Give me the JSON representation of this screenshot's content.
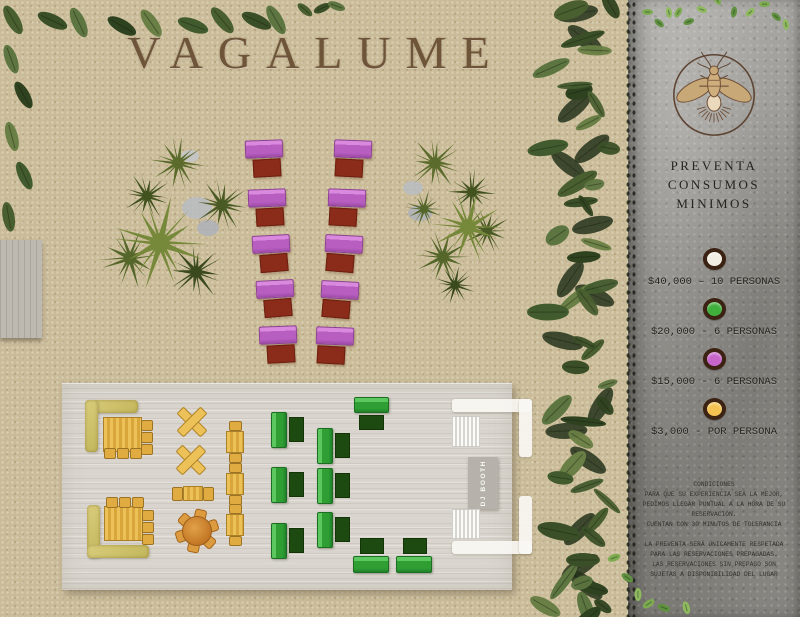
{
  "title": "VAGALUME",
  "sidebar": {
    "heading": [
      "PREVENTA",
      "CONSUMOS",
      "MINIMOS"
    ],
    "legend": [
      {
        "swatch": "#f3eee3",
        "category": "white-lounge",
        "label": "$40,000 – 10 PERSONAS"
      },
      {
        "swatch": "#3fae3b",
        "category": "green-daybed",
        "label": "$20,000 - 6 PERSONAS"
      },
      {
        "swatch": "#c765cb",
        "category": "magenta-daybed",
        "label": "$15,000 - 6 PERSONAS"
      },
      {
        "swatch": "#f4c351",
        "category": "gold-seating",
        "label": "$3,000  -  POR PERSONA"
      }
    ],
    "conditions_title": "CONDICIONES",
    "conditions_lines": [
      "PARA QUE SU EXPERIENCIA SEA LA MEJOR,",
      "PEDIMOS LLEGAR PUNTUAL A LA HORA DE SU",
      "RESERVACIÓN.",
      "CUENTAN CON 30 MINUTOS DE TOLERANCIA"
    ],
    "conditions_lines2": [
      "LA PREVENTA SERÁ ÚNICAMENTE RESPETADA",
      "PARA LAS RESERVACIONES PREPAGADAS.",
      "LAS RESERVACIONES SIN PREPAGO SON",
      "SUJETAS A DISPONIBILIDAD DEL LUGAR"
    ]
  },
  "map": {
    "dj_booth": "DJ BOOTH",
    "counts": {
      "magenta_daybeds": 10,
      "green_daybeds": 9,
      "white_lounges": 2,
      "gold_lounges": 2,
      "gold_x_tables": 2,
      "gold_dining_sets": 3,
      "gold_small_table": 1,
      "round_table": 1
    }
  },
  "colors": {
    "sand": "#cbbc99",
    "deck": "#d9d5ce",
    "stone_light": "#a8a7a3",
    "stone_dark": "#86847f",
    "magenta_bed": "#b75ec0",
    "red_table": "#8b2b1a",
    "green_bed": "#2f9e33",
    "green_table": "#1d4a10",
    "gold_furniture": "#e0ac42",
    "orange_table": "#c07423",
    "booth_gray": "#b6b2ab",
    "title_brown": "#6e5438",
    "ring_brown": "#3b2212"
  }
}
